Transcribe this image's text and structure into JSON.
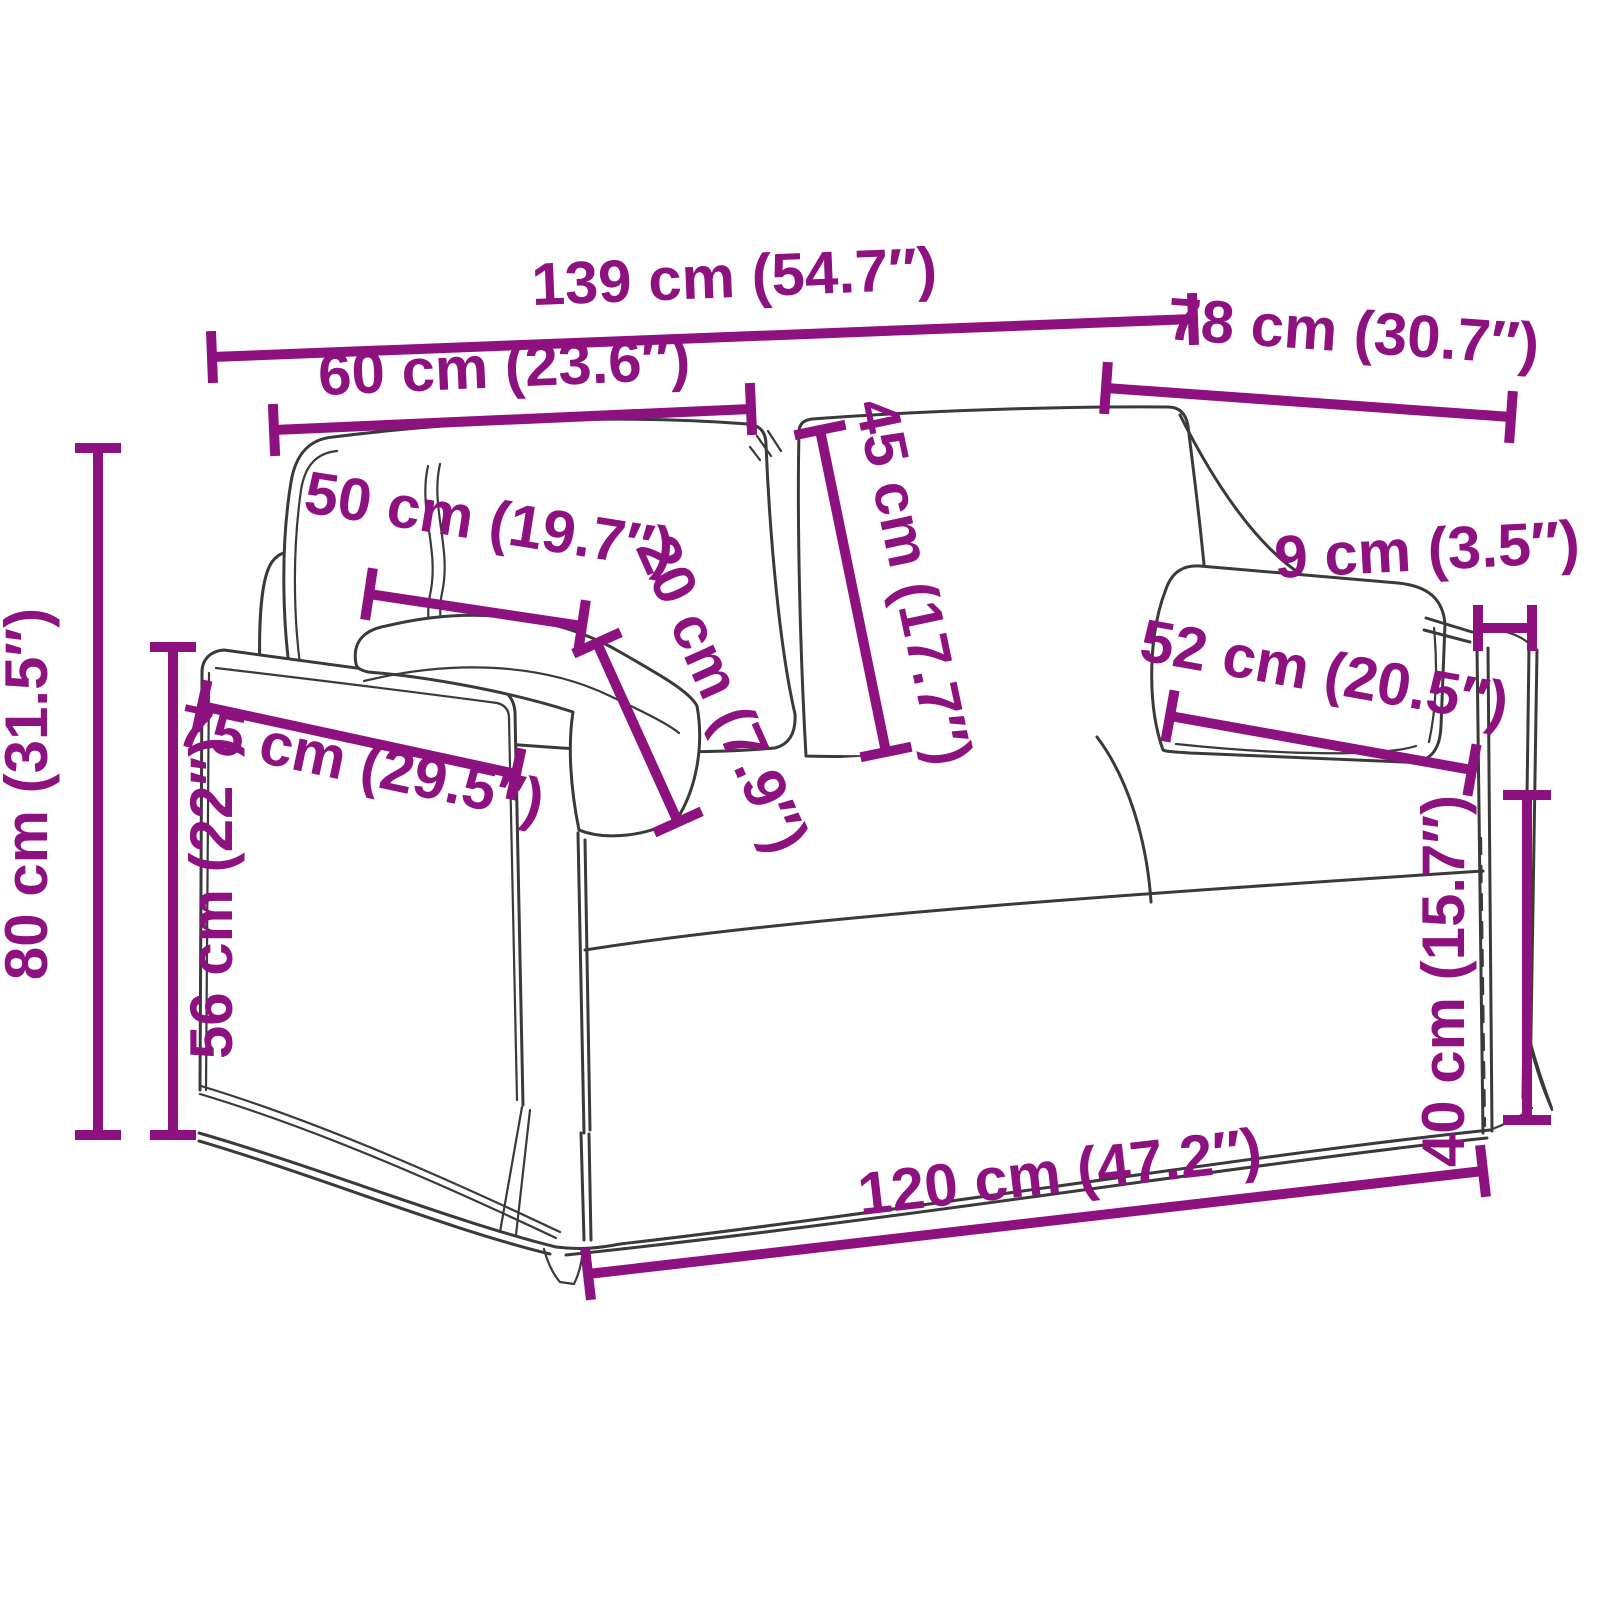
{
  "diagram": {
    "type": "product-dimension-drawing",
    "subject": "2-seater sofa bed with pillows, line-art with measurement annotations",
    "unit_primary": "cm",
    "unit_secondary": "in",
    "colors": {
      "dimension_accent": "#8e1180",
      "line_art": "#3a3a3a",
      "background": "#ffffff"
    },
    "dimensions": [
      {
        "name": "overall-width",
        "cm": 139,
        "inch": "54.7",
        "label": "139 cm (54.7″)",
        "g": {
          "x1": 212,
          "y1": 357,
          "x2": 1193,
          "y2": 319,
          "tick": 26,
          "lx": 735,
          "ly": 297,
          "rot": -2.3
        }
      },
      {
        "name": "overall-depth",
        "cm": 78,
        "inch": "30.7",
        "label": "78 cm (30.7″)",
        "g": {
          "x1": 1106,
          "y1": 388,
          "x2": 1511,
          "y2": 417,
          "tick": 26,
          "lx": 1352,
          "ly": 352,
          "rot": 4
        }
      },
      {
        "name": "backrest-width",
        "cm": 60,
        "inch": "23.6",
        "label": "60 cm (23.6″)",
        "g": {
          "x1": 274,
          "y1": 430,
          "x2": 751,
          "y2": 409,
          "tick": 26,
          "lx": 505,
          "ly": 387,
          "rot": -2.5
        }
      },
      {
        "name": "armrest-pad-length",
        "cm": 50,
        "inch": "19.7",
        "label": "50 cm (19.7″)",
        "g": {
          "x1": 369,
          "y1": 594,
          "x2": 582,
          "y2": 626,
          "tick": 26,
          "lx": 486,
          "ly": 541,
          "rot": 9
        }
      },
      {
        "name": "armrest-pad-drop",
        "cm": 20,
        "inch": "7.9",
        "label": "20 cm (7.9″)",
        "g": {
          "x1": 597,
          "y1": 643,
          "x2": 678,
          "y2": 822,
          "tick": 26,
          "lx": 704,
          "ly": 702,
          "rot": 66
        }
      },
      {
        "name": "backrest-height",
        "cm": 45,
        "inch": "17.7",
        "label": "45 cm (17.7″)",
        "g": {
          "x1": 820,
          "y1": 430,
          "x2": 886,
          "y2": 752,
          "tick": 26,
          "lx": 894,
          "ly": 586,
          "rot": 78
        }
      },
      {
        "name": "armrest-width",
        "cm": 9,
        "inch": "3.5",
        "label": "9 cm (3.5″)",
        "g": {
          "x1": 1478,
          "y1": 628,
          "x2": 1532,
          "y2": 628,
          "tick": 23,
          "lx": 1428,
          "ly": 570,
          "rot": -3
        }
      },
      {
        "name": "pillow-length",
        "cm": 52,
        "inch": "20.5",
        "label": "52 cm (20.5″)",
        "g": {
          "x1": 1170,
          "y1": 716,
          "x2": 1472,
          "y2": 770,
          "tick": 26,
          "lx": 1321,
          "ly": 692,
          "rot": 10
        }
      },
      {
        "name": "armrest-panel-depth",
        "cm": 75,
        "inch": "29.5",
        "label": "75 cm (29.5″)",
        "g": {
          "x1": 202,
          "y1": 706,
          "x2": 516,
          "y2": 774,
          "tick": 26,
          "lx": 357,
          "ly": 783,
          "rot": 12
        }
      },
      {
        "name": "overall-height",
        "cm": 80,
        "inch": "31.5",
        "label": "80 cm (31.5″)",
        "g": {
          "x1": 98,
          "y1": 448,
          "x2": 98,
          "y2": 1135,
          "tick": 23,
          "lx": 47,
          "ly": 794,
          "rot": -90
        }
      },
      {
        "name": "arm-height",
        "cm": 56,
        "inch": "22",
        "label": "56 cm (22″)",
        "g": {
          "x1": 173,
          "y1": 647,
          "x2": 173,
          "y2": 1135,
          "tick": 23,
          "lx": 232,
          "ly": 898,
          "rot": -90
        }
      },
      {
        "name": "seat-height",
        "cm": 40,
        "inch": "15.7",
        "label": "40 cm (15.7″)",
        "g": {
          "x1": 1527,
          "y1": 795,
          "x2": 1527,
          "y2": 1120,
          "tick": 24,
          "lx": 1464,
          "ly": 981,
          "rot": -90
        }
      },
      {
        "name": "seat-width",
        "cm": 120,
        "inch": "47.2",
        "label": "120 cm (47.2″)",
        "g": {
          "x1": 588,
          "y1": 1274,
          "x2": 1483,
          "y2": 1171,
          "tick": 26,
          "lx": 1062,
          "ly": 1192,
          "rot": -6.5
        }
      }
    ]
  }
}
